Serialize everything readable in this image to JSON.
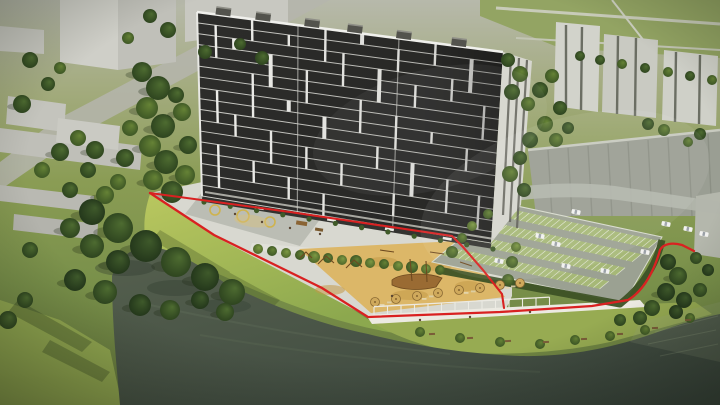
{
  "scene": {
    "type": "3d-architectural-rendering-aerial",
    "subject": "Residential complex on a lake shore with site boundary outlined in red",
    "labels": {
      "main_building": "residential high-rise tower",
      "boundary": "red site boundary line",
      "water": "lake",
      "beach": "sand beach playground with wooden structures and umbrellas",
      "promenade": "waterfront promenade with white pergolas",
      "parking": "surface parking lot with grass pavers and cars",
      "courtyard": "paved courtyard with playgrounds",
      "background": "existing low-rise city blocks and panel buildings",
      "vegetation": "trees, hedges and lawns"
    },
    "colors": {
      "water": "#49544a",
      "water_deep": "#39443c",
      "grass_sunlit": "#a9bb5c",
      "grass": "#7d9048",
      "grass_dark": "#55682f",
      "sand": "#dcb768",
      "pavement": "#d8d8d0",
      "promenade": "#eceae2",
      "asphalt": "#9ba192",
      "parking_grass": "#a7b976",
      "facade_dark": "#2c2c2a",
      "facade_white": "#eeeeea",
      "facade_end": "#d6d6ce",
      "background_building": "#c6c7bf",
      "big_building": "#9a9e93",
      "tree_dark": "#2f4a22",
      "tree_light": "#567a36",
      "hedge": "#3d5226",
      "boundary_red": "#d92121",
      "car_white": "#f2f2f0",
      "wood": "#8a5f2e",
      "umbrella": "#cfa95c",
      "bench_wood": "#7a5c38",
      "playground_yellow": "#d2b13c"
    },
    "counts": {
      "tower_floors": 17,
      "parked_cars": 10,
      "beach_umbrellas": 8,
      "pergola_posts": 14,
      "roof_units": 6,
      "waterfront_benches": 8
    }
  }
}
